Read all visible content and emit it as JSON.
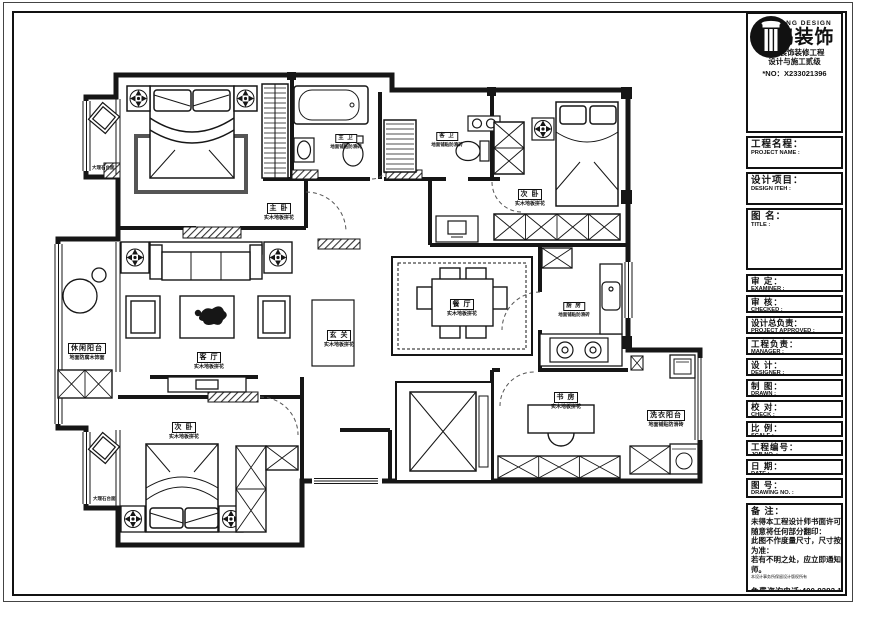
{
  "title_block": {
    "logo": {
      "brand_en": "NANHONG DESIGN",
      "brand_cn": "南鸿装饰",
      "cert_line1": "建筑装饰装修工程",
      "cert_line2": "设计与施工贰级",
      "license_no": "*NO：X233021396"
    },
    "fields": [
      {
        "cn": "工程名程：",
        "en": "PROJECT NAME :"
      },
      {
        "cn": "设计项目：",
        "en": "DESIGN ITEH :"
      },
      {
        "cn": "图 名：",
        "en": "TITLE :"
      },
      {
        "cn": "审 定：",
        "en": "EXAMINER :"
      },
      {
        "cn": "审 核：",
        "en": "CHECKED :"
      },
      {
        "cn": "设计总负责：",
        "en": "PROJECT APPROVED :"
      },
      {
        "cn": "工程负责：",
        "en": "MANAGER :"
      },
      {
        "cn": "设 计：",
        "en": "DESIGNER :"
      },
      {
        "cn": "制 图：",
        "en": "DRAWN :"
      },
      {
        "cn": "校 对：",
        "en": "CHECK :"
      },
      {
        "cn": "比 例：",
        "en": "SCALE :"
      },
      {
        "cn": "工程编号：",
        "en": "JOB NO. :"
      },
      {
        "cn": "日 期：",
        "en": "DATE :"
      },
      {
        "cn": "图 号：",
        "en": "DRAWING NO. :"
      }
    ],
    "remarks": {
      "title": "备 注：",
      "lines": [
        "未得本工程设计师书面许可不得",
        "随意将任何部分翻印：",
        "此图不作度量尺寸，尺寸按现场",
        "为准：",
        "若有不明之处，应立即通知设计",
        "师。"
      ],
      "fine_print": "本设计事务所保留设计版权所有",
      "hotline": "免费咨询电话:400 8383 168"
    }
  },
  "floor_plan": {
    "rooms": [
      {
        "name": "主 卧",
        "finish": "实木地板拼花"
      },
      {
        "name": "主 卫",
        "finish": "地面铺贴防滑砖"
      },
      {
        "name": "客 卫",
        "finish": "地面铺贴防滑砖"
      },
      {
        "name": "次 卧",
        "finish": "实木地板拼花"
      },
      {
        "name": "餐 厅",
        "finish": "实木地板拼花"
      },
      {
        "name": "厨 房",
        "finish": "地面铺贴防滑砖"
      },
      {
        "name": "客 厅",
        "finish": "实木地板拼花"
      },
      {
        "name": "玄 关",
        "finish": "实木地板拼花"
      },
      {
        "name": "休闲阳台",
        "finish": "地面防腐木饰面"
      },
      {
        "name": "书 房",
        "finish": "实木地板拼花"
      },
      {
        "name": "次 卧",
        "finish": "实木地板拼花"
      },
      {
        "name": "洗衣阳台",
        "finish": "地面铺贴防滑砖"
      }
    ],
    "annotations": [
      {
        "text": "大理石台面"
      },
      {
        "text": "大理石台面"
      }
    ]
  }
}
